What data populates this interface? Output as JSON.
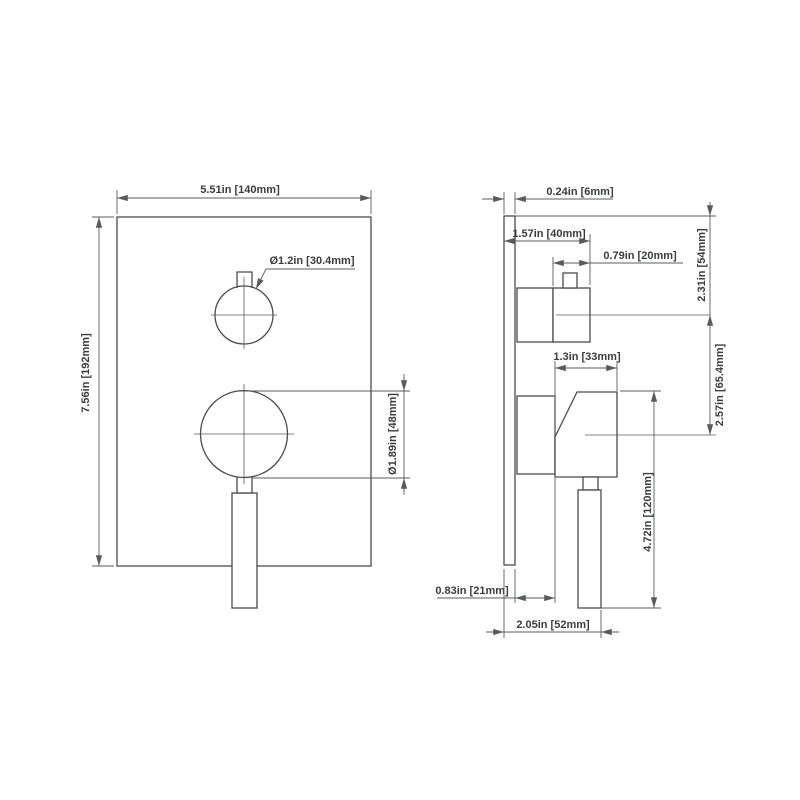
{
  "drawing_title": "shower valve trim dimensional drawing",
  "front": {
    "width_dim": "5.51in [140mm]",
    "height_dim": "7.56in [192mm]",
    "knob_diameter_label": "Ø1.2in [30.4mm]",
    "hub_diameter_dim": "Ø1.89in [48mm]"
  },
  "side": {
    "plate_thickness_dim": "0.24in [6mm]",
    "knob_projection_dim": "1.57in [40mm]",
    "knob_depth_dim": "0.79in [20mm]",
    "top_to_knob_center_dim": "2.31in [54mm]",
    "body_depth_dim": "1.3in [33mm]",
    "knob_center_spacing_dim": "2.57in [65.4mm]",
    "handle_length_dim": "4.72in [120mm]",
    "plate_to_body_dim": "0.83in [21mm]",
    "total_projection_dim": "2.05in [52mm]"
  },
  "colors": {
    "outline": "#4a4b4e",
    "dimension": "#5a5b5e",
    "text": "#3b3c3e",
    "background": "#ffffff"
  }
}
